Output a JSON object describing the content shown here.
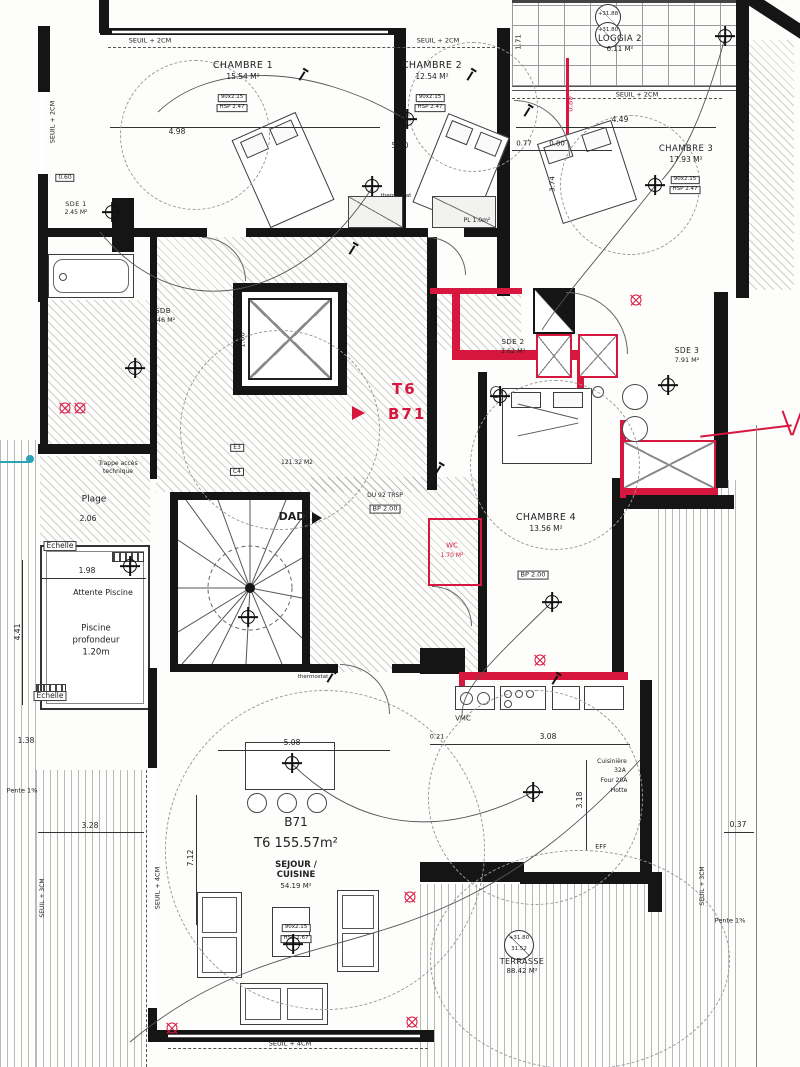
{
  "unit": {
    "type": "T6",
    "number": "B71"
  },
  "apartment": {
    "code": "B71",
    "type_area": "T6  155.57m²"
  },
  "rooms": {
    "chambre1": {
      "name": "CHAMBRE 1",
      "area": "15.54 M²"
    },
    "chambre2": {
      "name": "CHAMBRE 2",
      "area": "12.54 M²"
    },
    "chambre3": {
      "name": "CHAMBRE 3",
      "area": "17.93 M²"
    },
    "chambre4": {
      "name": "CHAMBRE 4",
      "area": "13.56 M²"
    },
    "loggia2": {
      "name": "LOGGIA 2",
      "area": "6.11 M²"
    },
    "sde1": {
      "name": "SDE 1",
      "area": "2.45 M²"
    },
    "sdb": {
      "name": "SDB",
      "area": "9.46 M²"
    },
    "sde2": {
      "name": "SDE 2",
      "area": "3.62 M²"
    },
    "sde3": {
      "name": "SDE 3",
      "area": "7.91 M²"
    },
    "sejour": {
      "name1": "SEJOUR /",
      "name2": "CUISINE",
      "area": "54.19 M²"
    },
    "terrasse": {
      "name": "TERRASSE",
      "area": "88.42 M²"
    }
  },
  "annotations": {
    "dad": "DAD"
  },
  "colors": {
    "wall": "#151515",
    "red": "#d8173f",
    "teal": "#2aa3b5"
  },
  "labels": [
    {
      "t": "SEUIL + 2CM",
      "x": 150,
      "y": 41,
      "s": 6.5,
      "n": "threshold-label"
    },
    {
      "t": "SEUIL + 2CM",
      "x": 438,
      "y": 41,
      "s": 6.5,
      "n": "threshold-label"
    },
    {
      "t": "SEUIL + 2CM",
      "x": 637,
      "y": 95,
      "s": 6.5,
      "n": "threshold-label"
    },
    {
      "t": "SEUIL + 2CM",
      "x": 53,
      "y": 122,
      "r": -90,
      "s": 6.5,
      "n": "threshold-label"
    },
    {
      "t": "SEUIL + 4CM",
      "x": 290,
      "y": 1044,
      "s": 6.5,
      "n": "threshold-label"
    },
    {
      "t": "SEUIL + 4CM",
      "x": 158,
      "y": 888,
      "r": -90,
      "s": 6.5,
      "n": "threshold-label"
    },
    {
      "t": "SEUIL + 3CM",
      "x": 703,
      "y": 886,
      "r": -90,
      "s": 6,
      "n": "threshold-label"
    },
    {
      "t": "SEUIL + 3CM",
      "x": 43,
      "y": 898,
      "r": -90,
      "s": 6,
      "n": "threshold-label"
    },
    {
      "t": "Trappe accès",
      "x": 118,
      "y": 464,
      "s": 6,
      "n": "hatch-access-label"
    },
    {
      "t": "technique",
      "x": 118,
      "y": 472,
      "s": 6,
      "n": "hatch-access-label"
    },
    {
      "t": "Plage",
      "x": 94,
      "y": 500,
      "s": 9,
      "n": "pool-deck-label"
    },
    {
      "t": "2.06",
      "x": 88,
      "y": 519,
      "s": 7.5,
      "n": "dimension-label"
    },
    {
      "t": "Echelle",
      "x": 60,
      "y": 546,
      "s": 7.5,
      "box": 1,
      "n": "ladder-label"
    },
    {
      "t": "1.98",
      "x": 87,
      "y": 571,
      "s": 7.5,
      "n": "dimension-label"
    },
    {
      "t": "Attente Piscine",
      "x": 103,
      "y": 593,
      "s": 8,
      "n": "pool-waiting-label"
    },
    {
      "t": "4.41",
      "x": 18,
      "y": 632,
      "r": -90,
      "s": 7.5,
      "n": "dimension-label"
    },
    {
      "t": "Piscine",
      "x": 96,
      "y": 629,
      "s": 8.5,
      "n": "pool-label"
    },
    {
      "t": "profondeur",
      "x": 96,
      "y": 641,
      "s": 8.5,
      "n": "pool-label"
    },
    {
      "t": "1.20m",
      "x": 96,
      "y": 653,
      "s": 8.5,
      "n": "pool-label"
    },
    {
      "t": "Echelle",
      "x": 50,
      "y": 696,
      "s": 7.5,
      "box": 1,
      "n": "ladder-label"
    },
    {
      "t": "1.38",
      "x": 26,
      "y": 741,
      "s": 7.5,
      "n": "dimension-label"
    },
    {
      "t": "Pente 1%",
      "x": 22,
      "y": 791,
      "s": 6.5,
      "n": "slope-label"
    },
    {
      "t": "3.28",
      "x": 90,
      "y": 826,
      "s": 7.5,
      "n": "dimension-label"
    },
    {
      "t": "7.12",
      "x": 191,
      "y": 858,
      "r": -90,
      "s": 7.5,
      "n": "dimension-label"
    },
    {
      "t": "5.08",
      "x": 292,
      "y": 743,
      "s": 7.5,
      "n": "dimension-label"
    },
    {
      "t": "0.21",
      "x": 437,
      "y": 737,
      "s": 6.5,
      "n": "dimension-label"
    },
    {
      "t": "3.08",
      "x": 548,
      "y": 737,
      "s": 7.5,
      "n": "dimension-label"
    },
    {
      "t": "3.18",
      "x": 580,
      "y": 800,
      "r": -90,
      "s": 7.5,
      "n": "dimension-label"
    },
    {
      "t": "0.37",
      "x": 738,
      "y": 825,
      "s": 7.5,
      "n": "dimension-label"
    },
    {
      "t": "Pente 1%",
      "x": 730,
      "y": 921,
      "s": 6.5,
      "n": "slope-label"
    },
    {
      "t": "4.98",
      "x": 177,
      "y": 132,
      "s": 7.5,
      "n": "dimension-label"
    },
    {
      "t": "5.50",
      "x": 400,
      "y": 146,
      "s": 7.5,
      "n": "dimension-label"
    },
    {
      "t": "4.49",
      "x": 620,
      "y": 120,
      "s": 7.5,
      "n": "dimension-label"
    },
    {
      "t": "0.77",
      "x": 524,
      "y": 144,
      "s": 7,
      "n": "dimension-label"
    },
    {
      "t": "0.80",
      "x": 557,
      "y": 144,
      "s": 7,
      "n": "dimension-label"
    },
    {
      "t": "3.74",
      "x": 553,
      "y": 184,
      "r": -90,
      "s": 7,
      "n": "dimension-label"
    },
    {
      "t": "1.71",
      "x": 519,
      "y": 42,
      "r": -90,
      "s": 7,
      "n": "dimension-label"
    },
    {
      "t": "0.80",
      "x": 571,
      "y": 104,
      "r": -90,
      "s": 7,
      "c": "#d8173f",
      "n": "dimension-label"
    },
    {
      "t": "1.60",
      "x": 243,
      "y": 340,
      "r": -90,
      "s": 7,
      "n": "dimension-label"
    },
    {
      "t": "thermostat",
      "x": 396,
      "y": 197,
      "s": 5.5,
      "n": "thermostat-label"
    },
    {
      "t": "thermostat",
      "x": 313,
      "y": 678,
      "s": 5.5,
      "n": "thermostat-label"
    },
    {
      "t": "PL 1.0m²",
      "x": 477,
      "y": 221,
      "s": 6,
      "n": "closet-label"
    },
    {
      "t": "121.32 M2",
      "x": 297,
      "y": 463,
      "s": 6,
      "n": "annotation-label"
    },
    {
      "t": "DU 92 TRSP",
      "x": 385,
      "y": 496,
      "s": 6,
      "n": "annotation-label"
    },
    {
      "t": "BP 2.00",
      "x": 385,
      "y": 509,
      "s": 6.5,
      "box": 1,
      "n": "tag-label"
    },
    {
      "t": "BP 2.00",
      "x": 533,
      "y": 575,
      "s": 6.5,
      "box": 1,
      "n": "tag-label"
    },
    {
      "t": "WC",
      "x": 452,
      "y": 546,
      "s": 7,
      "c": "#d8173f",
      "n": "wc-label"
    },
    {
      "t": "1.70 M²",
      "x": 452,
      "y": 556,
      "s": 6,
      "c": "#d8173f",
      "n": "wc-label"
    },
    {
      "t": "VMC",
      "x": 463,
      "y": 719,
      "s": 7,
      "n": "vmc-label"
    },
    {
      "t": "Cuisinière",
      "x": 612,
      "y": 762,
      "s": 6,
      "n": "kitchen-elec-label"
    },
    {
      "t": "32A",
      "x": 620,
      "y": 771,
      "s": 6,
      "n": "kitchen-elec-label"
    },
    {
      "t": "Four 20A",
      "x": 614,
      "y": 781,
      "s": 6,
      "n": "kitchen-elec-label"
    },
    {
      "t": "Hotte",
      "x": 619,
      "y": 791,
      "s": 6,
      "n": "kitchen-elec-label"
    },
    {
      "t": "EFF",
      "x": 601,
      "y": 847,
      "s": 6.5,
      "n": "annotation-label"
    },
    {
      "t": "MAV 2x8F",
      "x": 504,
      "y": 294,
      "s": 5.5,
      "c": "#d8173f",
      "n": "annotation-label"
    },
    {
      "t": "0.60",
      "x": 65,
      "y": 178,
      "s": 6,
      "box": 1,
      "n": "tag-label"
    },
    {
      "t": "E3",
      "x": 237,
      "y": 448,
      "s": 6,
      "box": 1,
      "n": "tag-label"
    },
    {
      "t": "C4",
      "x": 237,
      "y": 472,
      "s": 6,
      "box": 1,
      "n": "tag-label"
    },
    {
      "t": "90x2.15",
      "x": 232,
      "y": 98,
      "s": 5.5,
      "box": 1,
      "n": "door-tag"
    },
    {
      "t": "HSP 2.47",
      "x": 232,
      "y": 108,
      "s": 5.5,
      "box": 1,
      "n": "height-tag"
    },
    {
      "t": "90x2.15",
      "x": 430,
      "y": 98,
      "s": 5.5,
      "box": 1,
      "n": "door-tag"
    },
    {
      "t": "HSP 2.47",
      "x": 430,
      "y": 108,
      "s": 5.5,
      "box": 1,
      "n": "height-tag"
    },
    {
      "t": "90x2.15",
      "x": 685,
      "y": 180,
      "s": 5.5,
      "box": 1,
      "n": "door-tag"
    },
    {
      "t": "HSP 2.47",
      "x": 685,
      "y": 190,
      "s": 5.5,
      "box": 1,
      "n": "height-tag"
    },
    {
      "t": "90x2.15",
      "x": 296,
      "y": 928,
      "s": 5.5,
      "box": 1,
      "n": "door-tag"
    },
    {
      "t": "HSP 2.67",
      "x": 296,
      "y": 939,
      "s": 5.5,
      "box": 1,
      "n": "height-tag"
    },
    {
      "t": "+31.88",
      "x": 608,
      "y": 15,
      "s": 5.5,
      "n": "level-value"
    },
    {
      "t": "+31.80",
      "x": 608,
      "y": 31,
      "s": 5.5,
      "n": "level-value"
    },
    {
      "t": "+31.80",
      "x": 519,
      "y": 939,
      "s": 5.5,
      "n": "level-value"
    },
    {
      "t": "31.52",
      "x": 519,
      "y": 950,
      "s": 5.5,
      "n": "level-value"
    }
  ],
  "symbols": [
    {
      "k": "light",
      "x": 407,
      "y": 119
    },
    {
      "k": "light",
      "x": 112,
      "y": 212
    },
    {
      "k": "light",
      "x": 372,
      "y": 186
    },
    {
      "k": "light",
      "x": 655,
      "y": 185
    },
    {
      "k": "light",
      "x": 725,
      "y": 36
    },
    {
      "k": "light",
      "x": 500,
      "y": 396
    },
    {
      "k": "light",
      "x": 552,
      "y": 602
    },
    {
      "k": "light",
      "x": 292,
      "y": 763
    },
    {
      "k": "light",
      "x": 293,
      "y": 944
    },
    {
      "k": "light",
      "x": 533,
      "y": 792
    },
    {
      "k": "light",
      "x": 130,
      "y": 566
    },
    {
      "k": "light",
      "x": 135,
      "y": 368
    },
    {
      "k": "light",
      "x": 248,
      "y": 617
    },
    {
      "k": "light",
      "x": 668,
      "y": 385
    },
    {
      "k": "spotR",
      "x": 636,
      "y": 300
    },
    {
      "k": "spotR",
      "x": 410,
      "y": 897
    },
    {
      "k": "spotR",
      "x": 412,
      "y": 1022
    },
    {
      "k": "spotR",
      "x": 172,
      "y": 1028
    },
    {
      "k": "spotR",
      "x": 540,
      "y": 660
    },
    {
      "k": "spotR",
      "x": 65,
      "y": 408
    },
    {
      "k": "spotR",
      "x": 80,
      "y": 408
    },
    {
      "k": "switch",
      "x": 302,
      "y": 76
    },
    {
      "k": "switch",
      "x": 470,
      "y": 76
    },
    {
      "k": "switch",
      "x": 527,
      "y": 112
    },
    {
      "k": "switch",
      "x": 352,
      "y": 250
    },
    {
      "k": "switch",
      "x": 438,
      "y": 470
    },
    {
      "k": "switch",
      "x": 330,
      "y": 678
    },
    {
      "k": "switch",
      "x": 555,
      "y": 680
    }
  ]
}
